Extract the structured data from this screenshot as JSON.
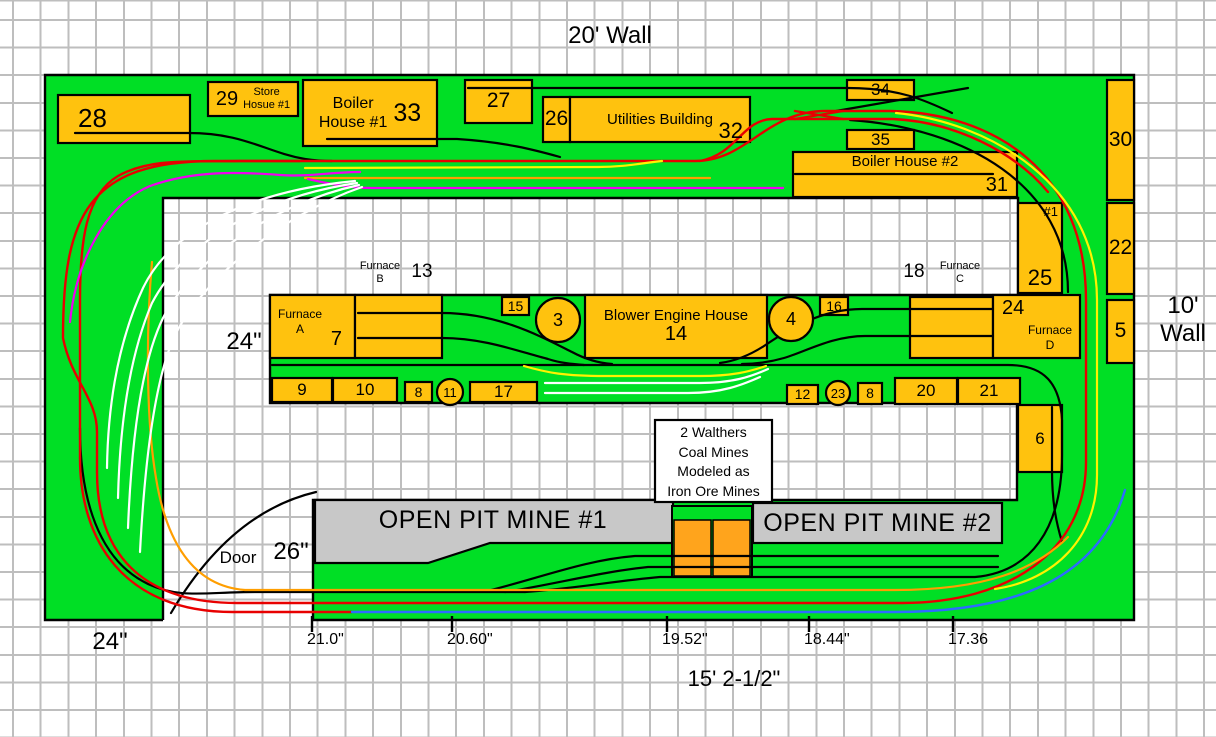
{
  "title": {
    "top_wall": "20' Wall",
    "right_wall": "10'\nWall",
    "bottom_dimension": "15' 2-1/2\""
  },
  "dimensions": {
    "left_width": "24\"",
    "aisle_width": "24\"",
    "door_label": "Door",
    "door_width": "26\"",
    "bottom_segments": [
      {
        "label": "21.0\"",
        "x": 312
      },
      {
        "label": "20.60\"",
        "x": 452
      },
      {
        "label": "19.52\"",
        "x": 667
      },
      {
        "label": "18.44\"",
        "x": 809
      },
      {
        "label": "17.36",
        "x": 953
      }
    ]
  },
  "note_box": {
    "x": 655,
    "y": 420,
    "w": 117,
    "h": 82,
    "lines": [
      "2 Walthers",
      "Coal Mines",
      "Modeled as",
      "Iron Ore Mines"
    ]
  },
  "mines": [
    {
      "id": "open-pit-mine-1",
      "label": "OPEN PIT MINE #1",
      "lx": 328,
      "ly": 506,
      "lw": 330,
      "fs": 25
    },
    {
      "id": "open-pit-mine-2",
      "label": "OPEN PIT MINE #2",
      "lx": 753,
      "ly": 509,
      "lw": 249,
      "fs": 25
    }
  ],
  "buildings": [
    {
      "id": "28",
      "num": "28",
      "x": 58,
      "y": 95,
      "w": 132,
      "h": 48,
      "style": "numLeft"
    },
    {
      "id": "store-house-1",
      "num": "29",
      "name": "Store\nHosue #1",
      "x": 208,
      "y": 82,
      "w": 90,
      "h": 34,
      "style": "b29"
    },
    {
      "id": "boiler-house-1",
      "name": "Boiler\nHouse #1",
      "num": "33",
      "x": 303,
      "y": 80,
      "w": 134,
      "h": 66,
      "style": "b33"
    },
    {
      "id": "27",
      "num": "27",
      "x": 465,
      "y": 80,
      "w": 67,
      "h": 43,
      "style": "big"
    },
    {
      "id": "26",
      "num": "26",
      "x": 543,
      "y": 97,
      "w": 27,
      "h": 45,
      "style": "big"
    },
    {
      "id": "utilities-building",
      "name": "Utilities Building",
      "num": "32",
      "x": 570,
      "y": 97,
      "w": 180,
      "h": 45,
      "style": "b32"
    },
    {
      "id": "34",
      "num": "34",
      "x": 847,
      "y": 80,
      "w": 67,
      "h": 20,
      "style": "med"
    },
    {
      "id": "35",
      "num": "35",
      "x": 847,
      "y": 130,
      "w": 67,
      "h": 19,
      "style": "med"
    },
    {
      "id": "boiler-house-2",
      "name": "Boiler House #2",
      "num": "31",
      "x": 793,
      "y": 152,
      "w": 224,
      "h": 45,
      "style": "b31"
    },
    {
      "id": "30",
      "num": "30",
      "x": 1107,
      "y": 80,
      "w": 27,
      "h": 120,
      "style": "big"
    },
    {
      "id": "stock-house-1",
      "name": "#1",
      "num": "25",
      "x": 1018,
      "y": 203,
      "w": 44,
      "h": 90,
      "style": "bsh"
    },
    {
      "id": "22",
      "num": "22",
      "x": 1107,
      "y": 203,
      "w": 27,
      "h": 91,
      "style": "big"
    },
    {
      "id": "5",
      "num": "5",
      "x": 1107,
      "y": 300,
      "w": 27,
      "h": 63,
      "style": "big"
    },
    {
      "id": "furnace-a",
      "name": "Furnace\nA",
      "num": "7",
      "x": 270,
      "y": 295,
      "w": 85,
      "h": 63,
      "style": "bfa"
    },
    {
      "id": "cast-shed-b",
      "x": 355,
      "y": 295,
      "w": 87,
      "h": 63,
      "style": ""
    },
    {
      "id": "15",
      "num": "15",
      "x": 502,
      "y": 297,
      "w": 27,
      "h": 18,
      "style": "sm"
    },
    {
      "id": "blower-engine-house",
      "name": "Blower Engine House",
      "num": "14",
      "x": 585,
      "y": 295,
      "w": 182,
      "h": 63,
      "style": "bstack"
    },
    {
      "id": "16",
      "num": "16",
      "x": 820,
      "y": 297,
      "w": 28,
      "h": 18,
      "style": "sm"
    },
    {
      "id": "cast-shed-c",
      "x": 910,
      "y": 297,
      "w": 83,
      "h": 61,
      "style": ""
    },
    {
      "id": "furnace-d",
      "num": "24",
      "name": "Furnace\nD",
      "x": 993,
      "y": 295,
      "w": 87,
      "h": 63,
      "style": "bfd"
    },
    {
      "id": "9",
      "num": "9",
      "x": 272,
      "y": 378,
      "w": 60,
      "h": 24,
      "style": "med"
    },
    {
      "id": "10",
      "num": "10",
      "x": 333,
      "y": 378,
      "w": 64,
      "h": 24,
      "style": "med"
    },
    {
      "id": "8a",
      "num": "8",
      "x": 405,
      "y": 382,
      "w": 27,
      "h": 20,
      "style": "sm"
    },
    {
      "id": "17",
      "num": "17",
      "x": 470,
      "y": 382,
      "w": 67,
      "h": 20,
      "style": "med"
    },
    {
      "id": "12",
      "num": "12",
      "x": 787,
      "y": 385,
      "w": 31,
      "h": 19,
      "style": "sm"
    },
    {
      "id": "8b",
      "num": "8",
      "x": 858,
      "y": 383,
      "w": 24,
      "h": 21,
      "style": "sm"
    },
    {
      "id": "20",
      "num": "20",
      "x": 895,
      "y": 378,
      "w": 62,
      "h": 26,
      "style": "med"
    },
    {
      "id": "21",
      "num": "21",
      "x": 958,
      "y": 378,
      "w": 62,
      "h": 26,
      "style": "med"
    },
    {
      "id": "6",
      "num": "6",
      "x": 1018,
      "y": 405,
      "w": 44,
      "h": 67,
      "style": "med"
    }
  ],
  "circles": [
    {
      "id": "stove-3",
      "label": "3",
      "cx": 558,
      "cy": 320,
      "r": 22,
      "fs": 18
    },
    {
      "id": "stove-4",
      "label": "4",
      "cx": 791,
      "cy": 319,
      "r": 22,
      "fs": 18
    },
    {
      "id": "11",
      "label": "11",
      "cx": 450,
      "cy": 392,
      "r": 13,
      "fs": 13
    },
    {
      "id": "23",
      "label": "23",
      "cx": 838,
      "cy": 393,
      "r": 12,
      "fs": 13
    }
  ],
  "captions": [
    {
      "id": "wall-top-label",
      "text": "20' Wall",
      "x": 540,
      "y": 22,
      "w": 140,
      "fs": 24
    },
    {
      "id": "wall-right-label",
      "text": "10'\nWall",
      "x": 1152,
      "y": 292,
      "w": 62,
      "fs": 24
    },
    {
      "id": "furnace-b-caption",
      "text": "Furnace\nB",
      "x": 352,
      "y": 260,
      "w": 56,
      "fs": 11
    },
    {
      "id": "furnace-b-number",
      "text": "13",
      "x": 404,
      "y": 261,
      "w": 36,
      "fs": 19
    },
    {
      "id": "furnace-c-number",
      "text": "18",
      "x": 896,
      "y": 261,
      "w": 36,
      "fs": 19
    },
    {
      "id": "furnace-c-caption",
      "text": "Furnace\nC",
      "x": 932,
      "y": 260,
      "w": 56,
      "fs": 11
    },
    {
      "id": "aisle-width-label",
      "text": "24\"",
      "x": 218,
      "y": 328,
      "w": 52,
      "fs": 24
    },
    {
      "id": "door-label",
      "text": "Door",
      "x": 212,
      "y": 548,
      "w": 52,
      "fs": 17
    },
    {
      "id": "door-width-label",
      "text": "26\"",
      "x": 264,
      "y": 538,
      "w": 54,
      "fs": 24
    },
    {
      "id": "left-width-label",
      "text": "24\"",
      "x": 82,
      "y": 628,
      "w": 56,
      "fs": 24
    },
    {
      "id": "bottom-dimension-label",
      "text": "15' 2-1/2\"",
      "x": 664,
      "y": 666,
      "w": 140,
      "fs": 22
    }
  ],
  "palette": {
    "benchwork_green": "#00DF25",
    "building_yellow": "#FFC20E",
    "mine_gray": "#C8C8C8",
    "structure_orange": "#FFA41C",
    "grid_gray": "#BEBEBE",
    "track_colors": {
      "mainline_red": "#E80000",
      "siding_black": "#000000",
      "staging_white": "#FFFFFF",
      "branch_magenta": "#F000F0",
      "branch_orange": "#FF9E00",
      "branch_yellow": "#FFF200",
      "branch_blue": "#2D6BFF"
    }
  }
}
